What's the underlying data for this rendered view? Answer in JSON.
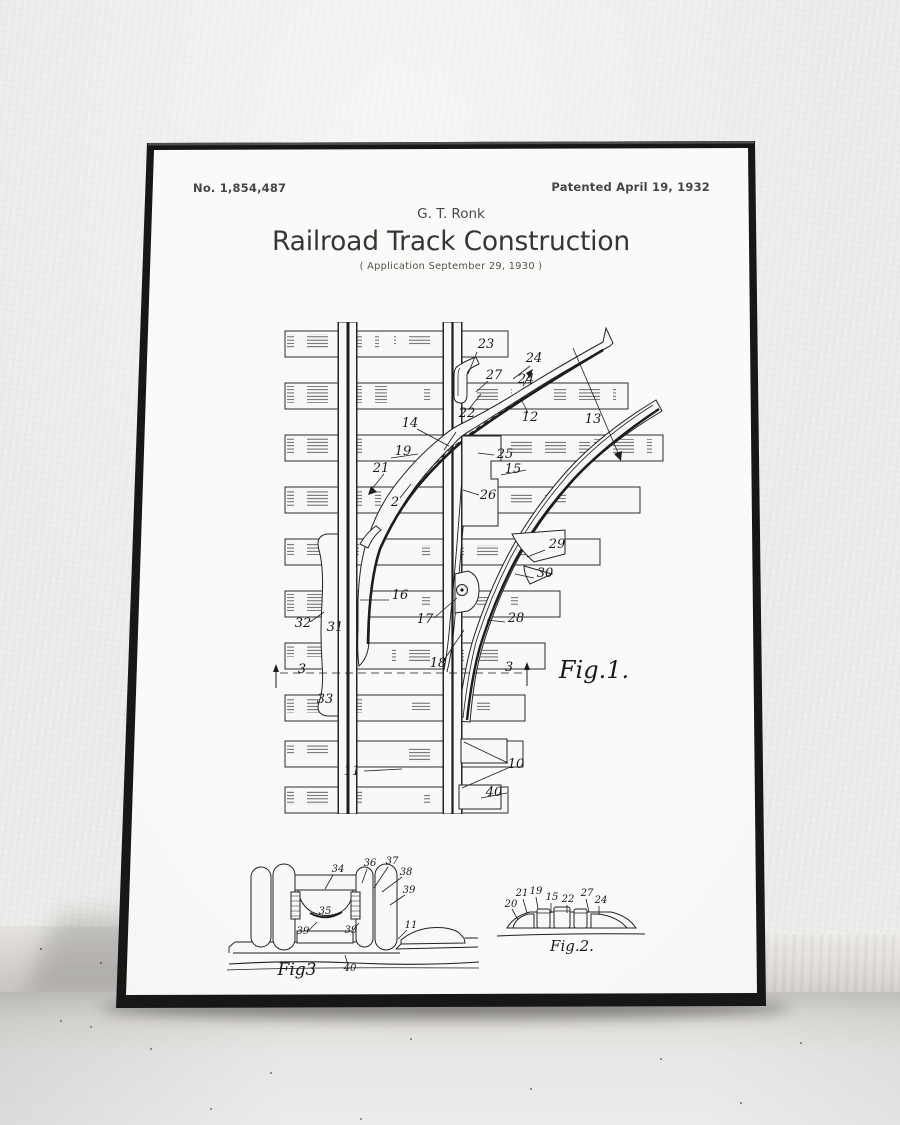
{
  "poster": {
    "patent_number": "No. 1,854,487",
    "patent_date": "Patented April 19, 1932",
    "inventor": "G. T. Ronk",
    "title": "Railroad Track Construction",
    "application_line": "( Application  September 29, 1930 )"
  },
  "colors": {
    "frame": "#171717",
    "paper": "#f9f8f6",
    "wall": "#efedeb",
    "floor": "#e9e7e5",
    "ink": "#1d1d1d"
  },
  "figures": [
    {
      "id": "fig1-labels",
      "caption": "Fig.1.",
      "items": [
        {
          "t": "23",
          "x": 214,
          "y": 26
        },
        {
          "t": "24",
          "x": 262,
          "y": 40
        },
        {
          "t": "27",
          "x": 222,
          "y": 57
        },
        {
          "t": "24",
          "x": 254,
          "y": 61
        },
        {
          "t": "22",
          "x": 195,
          "y": 95
        },
        {
          "t": "12",
          "x": 258,
          "y": 99
        },
        {
          "t": "13",
          "x": 321,
          "y": 101
        },
        {
          "t": "14",
          "x": 138,
          "y": 105
        },
        {
          "t": "19",
          "x": 131,
          "y": 133
        },
        {
          "t": "25",
          "x": 233,
          "y": 136
        },
        {
          "t": "21",
          "x": 109,
          "y": 150
        },
        {
          "t": "15",
          "x": 241,
          "y": 151
        },
        {
          "t": "26",
          "x": 216,
          "y": 177
        },
        {
          "t": "2",
          "x": 123,
          "y": 184
        },
        {
          "t": "29",
          "x": 285,
          "y": 226
        },
        {
          "t": "30",
          "x": 273,
          "y": 255
        },
        {
          "t": "16",
          "x": 128,
          "y": 277
        },
        {
          "t": "17",
          "x": 153,
          "y": 301
        },
        {
          "t": "28",
          "x": 244,
          "y": 300
        },
        {
          "t": "32",
          "x": 31,
          "y": 305
        },
        {
          "t": "31",
          "x": 63,
          "y": 309
        },
        {
          "t": "18",
          "x": 166,
          "y": 345
        },
        {
          "t": "3",
          "x": 30,
          "y": 351
        },
        {
          "t": "3",
          "x": 237,
          "y": 349
        },
        {
          "t": "33",
          "x": 53,
          "y": 381
        },
        {
          "t": "11",
          "x": 80,
          "y": 453
        },
        {
          "t": "10",
          "x": 244,
          "y": 446
        },
        {
          "t": "40",
          "x": 222,
          "y": 474
        },
        {
          "t": "Fig.1.",
          "x": 322,
          "y": 356,
          "s": 24,
          "c": "cap"
        }
      ]
    },
    {
      "id": "fig23-labels",
      "caption": "Fig3 / Fig.2.",
      "items": [
        {
          "t": "34",
          "x": 123,
          "y": 29
        },
        {
          "t": "36",
          "x": 155,
          "y": 23
        },
        {
          "t": "37",
          "x": 177,
          "y": 21
        },
        {
          "t": "38",
          "x": 191,
          "y": 32
        },
        {
          "t": "39",
          "x": 194,
          "y": 50
        },
        {
          "t": "35",
          "x": 110,
          "y": 71
        },
        {
          "t": "39",
          "x": 88,
          "y": 91
        },
        {
          "t": "39",
          "x": 136,
          "y": 90
        },
        {
          "t": "11",
          "x": 196,
          "y": 85
        },
        {
          "t": "40",
          "x": 135,
          "y": 128
        },
        {
          "t": "Fig3",
          "x": 82,
          "y": 132,
          "s": 17,
          "c": "cap"
        },
        {
          "t": "20",
          "x": 296,
          "y": 64
        },
        {
          "t": "21",
          "x": 307,
          "y": 53
        },
        {
          "t": "19",
          "x": 321,
          "y": 51
        },
        {
          "t": "15",
          "x": 337,
          "y": 57
        },
        {
          "t": "22",
          "x": 353,
          "y": 59
        },
        {
          "t": "27",
          "x": 372,
          "y": 53
        },
        {
          "t": "24",
          "x": 386,
          "y": 60
        },
        {
          "t": "Fig.2.",
          "x": 357,
          "y": 108,
          "s": 15,
          "c": "cap"
        }
      ]
    }
  ]
}
